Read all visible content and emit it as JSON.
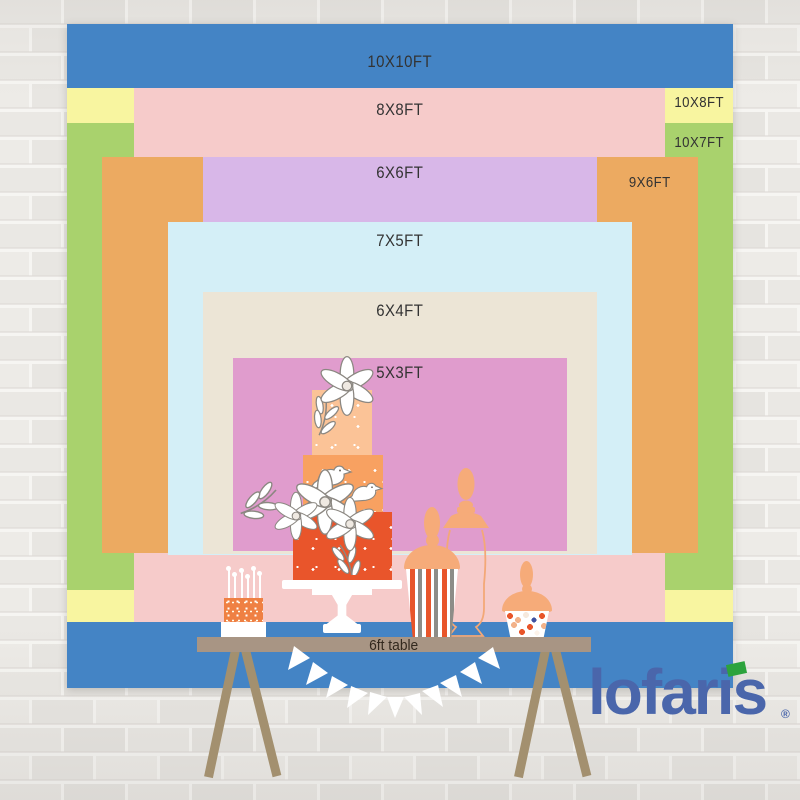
{
  "backdrop_sizes": [
    {
      "label": "10X10FT",
      "color": "#4484c5"
    },
    {
      "label": "10X8FT",
      "color": "#f8f5a0"
    },
    {
      "label": "10X7FT",
      "color": "#a9d26d"
    },
    {
      "label": "8X8FT",
      "color": "#f6cbca"
    },
    {
      "label": "9X6FT",
      "color": "#ecaa61"
    },
    {
      "label": "6X6FT",
      "color": "#d8b7e8"
    },
    {
      "label": "7X5FT",
      "color": "#d4eff7"
    },
    {
      "label": "6X4FT",
      "color": "#ece5d6"
    },
    {
      "label": "5X3FT",
      "color": "#e09ccd"
    }
  ],
  "table": {
    "label": "6ft table",
    "surface_color": "#a89584",
    "leg_color": "#a3906f"
  },
  "cake": {
    "top_tier_color": "#fbc397",
    "middle_tier_color": "#f8a161",
    "bottom_tier_color": "#e9552b"
  },
  "brand": {
    "wordmark": "lofaris",
    "registered_mark": "®",
    "text_color": "#4a66ab",
    "dot_color": "#2ca33d"
  }
}
